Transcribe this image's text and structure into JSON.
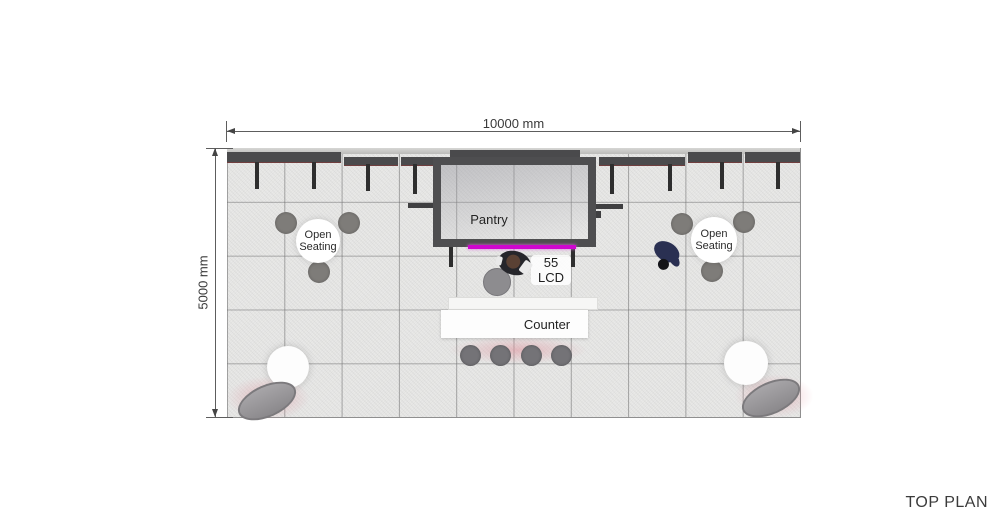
{
  "plan": {
    "title": "TOP PLAN",
    "dimensions": {
      "width": "10000 mm",
      "height": "5000 mm"
    },
    "pantry_label": "Pantry",
    "counter_label": "Counter",
    "lcd_label_line1": "55",
    "lcd_label_line2": "LCD",
    "seating_left_label": "Open Seating",
    "seating_right_label": "Open Seating"
  },
  "colors": {
    "accent_magenta": "#CF06CF",
    "wall_dark": "#4A4A4C",
    "floor_gray": "#E9E9E8",
    "pink_glow": "#E0949E",
    "furniture_gray": "#7E7C79"
  }
}
